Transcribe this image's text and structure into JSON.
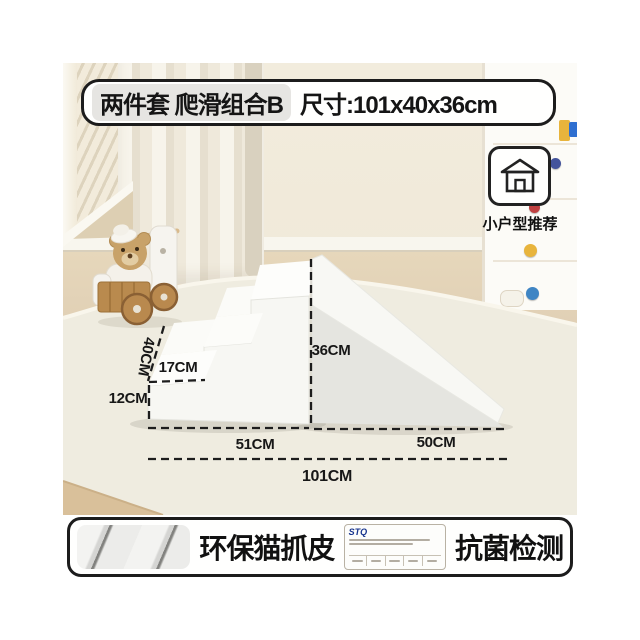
{
  "product_banner": {
    "set_label": "两件套 爬滑组合B",
    "size_label": "尺寸:101x40x36cm"
  },
  "recommend_badge": {
    "icon": "house-icon",
    "caption": "小户型推荐"
  },
  "dimensions": {
    "depth": "40CM",
    "step_depth": "17CM",
    "step_height": "12CM",
    "slide_height": "36CM",
    "stairs_length": "51CM",
    "slide_length": "50CM",
    "total_length": "101CM"
  },
  "feature_banner": {
    "material_label": "环保猫抓皮",
    "certificate_brand": "STQ",
    "test_label": "抗菌检测"
  },
  "colors": {
    "banner_border": "#1c1c1c",
    "certificate_brand_blue": "#17348e",
    "product_white": "#f8f8f4",
    "slide_face_gray": "#e5e5e0",
    "knob_navy": "#44549c",
    "knob_red": "#bf4040",
    "knob_yellow": "#e8b43c",
    "knob_blue": "#3f85c4"
  }
}
